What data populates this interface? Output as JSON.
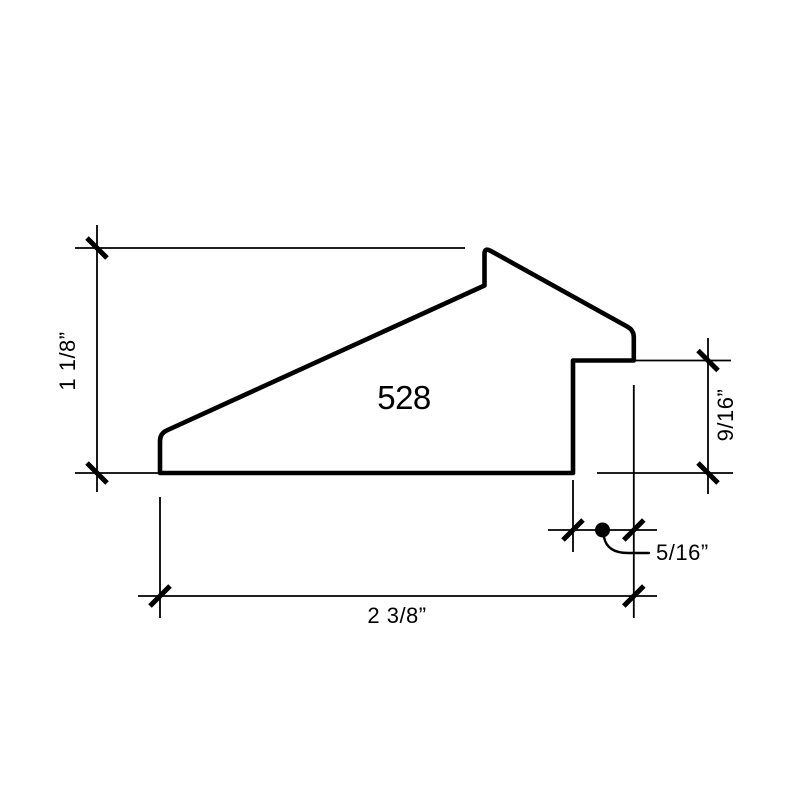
{
  "canvas": {
    "background": "#ffffff",
    "ink": "#000000"
  },
  "drawing": {
    "part_number": "528",
    "dimensions": {
      "overall_height": {
        "label": "1 1/8”"
      },
      "overall_width": {
        "label": "2 3/8”"
      },
      "rabbet_height": {
        "label": "9/16”"
      },
      "rabbet_width": {
        "label": "5/16”"
      }
    }
  }
}
